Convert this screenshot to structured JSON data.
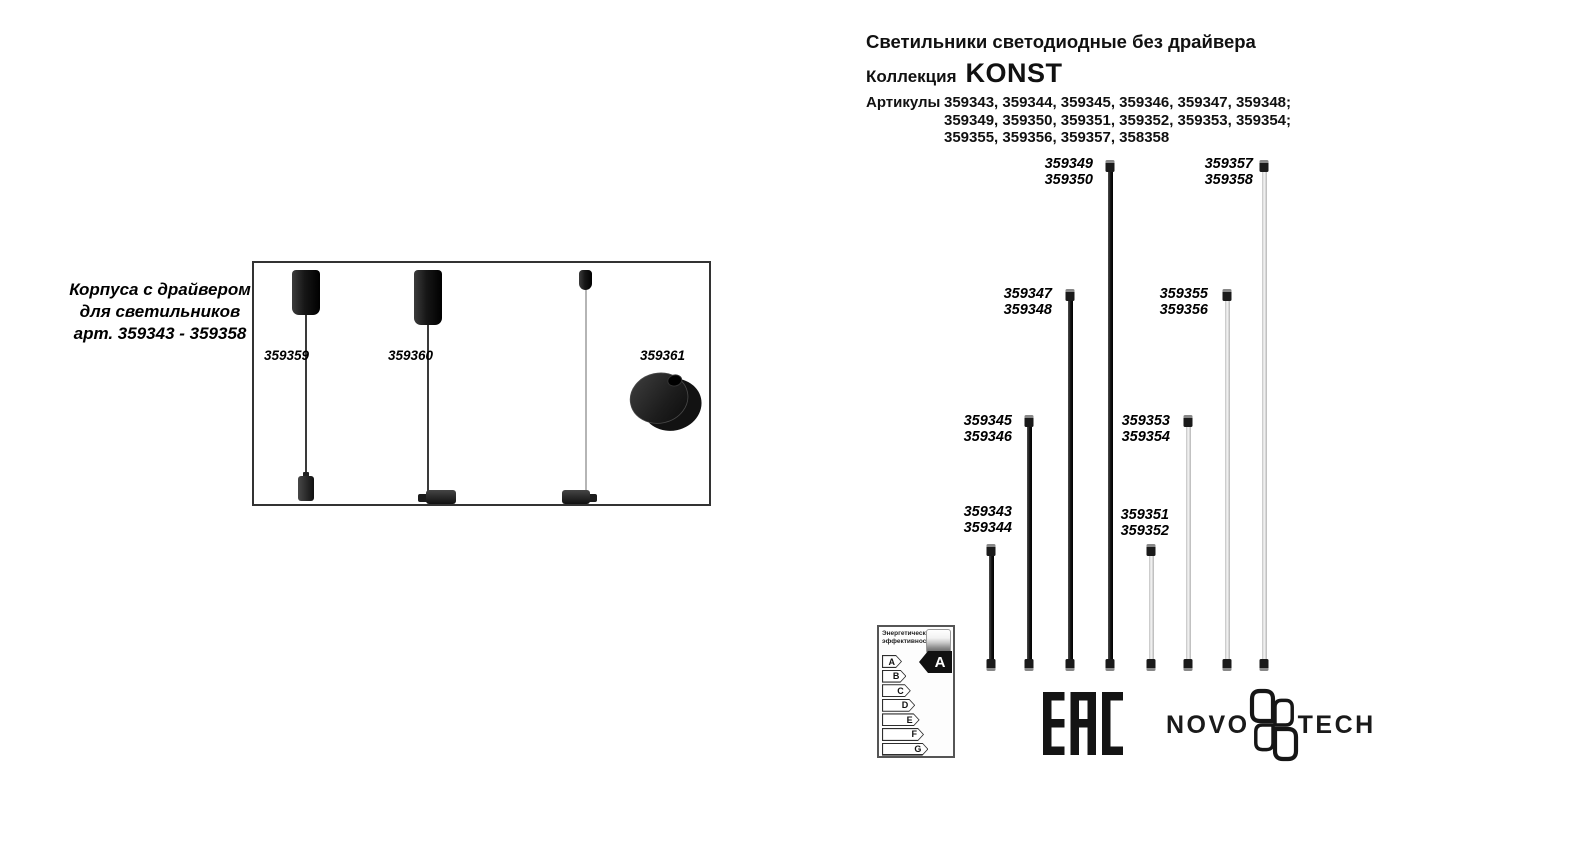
{
  "header": {
    "title": "Светильники светодиодные без драйвера",
    "collection_label": "Коллекция",
    "collection_name": "KONST",
    "articles_label": "Артикулы",
    "articles_lines": [
      "359343, 359344, 359345, 359346, 359347, 359348;",
      "359349, 359350, 359351, 359352, 359353, 359354;",
      "359355, 359356, 359357, 358358"
    ]
  },
  "left_panel": {
    "caption_lines": [
      "Корпуса с драйвером",
      "для светильников",
      "арт. 359343 - 359358"
    ],
    "pendant_labels": [
      "359359",
      "359360",
      "359361"
    ]
  },
  "diagram": {
    "baseline_y": 670,
    "tubes": [
      {
        "articles": [
          "359343",
          "359344"
        ],
        "finish": "dark",
        "x": 991,
        "top": 545,
        "label_x": 955,
        "label_y": 505
      },
      {
        "articles": [
          "359345",
          "359346"
        ],
        "finish": "dark",
        "x": 1029,
        "top": 416,
        "label_x": 955,
        "label_y": 414
      },
      {
        "articles": [
          "359347",
          "359348"
        ],
        "finish": "dark",
        "x": 1070,
        "top": 290,
        "label_x": 995,
        "label_y": 287
      },
      {
        "articles": [
          "359349",
          "359350"
        ],
        "finish": "dark",
        "x": 1110,
        "top": 161,
        "label_x": 1036,
        "label_y": 157
      },
      {
        "articles": [
          "359351",
          "359352"
        ],
        "finish": "light",
        "x": 1151,
        "top": 545,
        "label_x": 1112,
        "label_y": 508
      },
      {
        "articles": [
          "359353",
          "359354"
        ],
        "finish": "light",
        "x": 1188,
        "top": 416,
        "label_x": 1113,
        "label_y": 414
      },
      {
        "articles": [
          "359355",
          "359356"
        ],
        "finish": "light",
        "x": 1227,
        "top": 290,
        "label_x": 1151,
        "label_y": 287
      },
      {
        "articles": [
          "359357",
          "359358"
        ],
        "finish": "light",
        "x": 1264,
        "top": 161,
        "label_x": 1196,
        "label_y": 157
      }
    ]
  },
  "energy_label": {
    "title_lines": [
      "Энергетическая",
      "эффективность"
    ],
    "classes": [
      "A",
      "B",
      "C",
      "D",
      "E",
      "F",
      "G"
    ],
    "rating": "A"
  },
  "certification": {
    "eac_text": "EAC"
  },
  "brand": {
    "word_left": "NOVO",
    "word_right": "TECH",
    "glyph": "four-petal-clover-icon"
  },
  "colors": {
    "ink": "#111111",
    "tube_dark": "#1a1a1a",
    "tube_light": "#e8e8e8",
    "background": "#ffffff"
  }
}
